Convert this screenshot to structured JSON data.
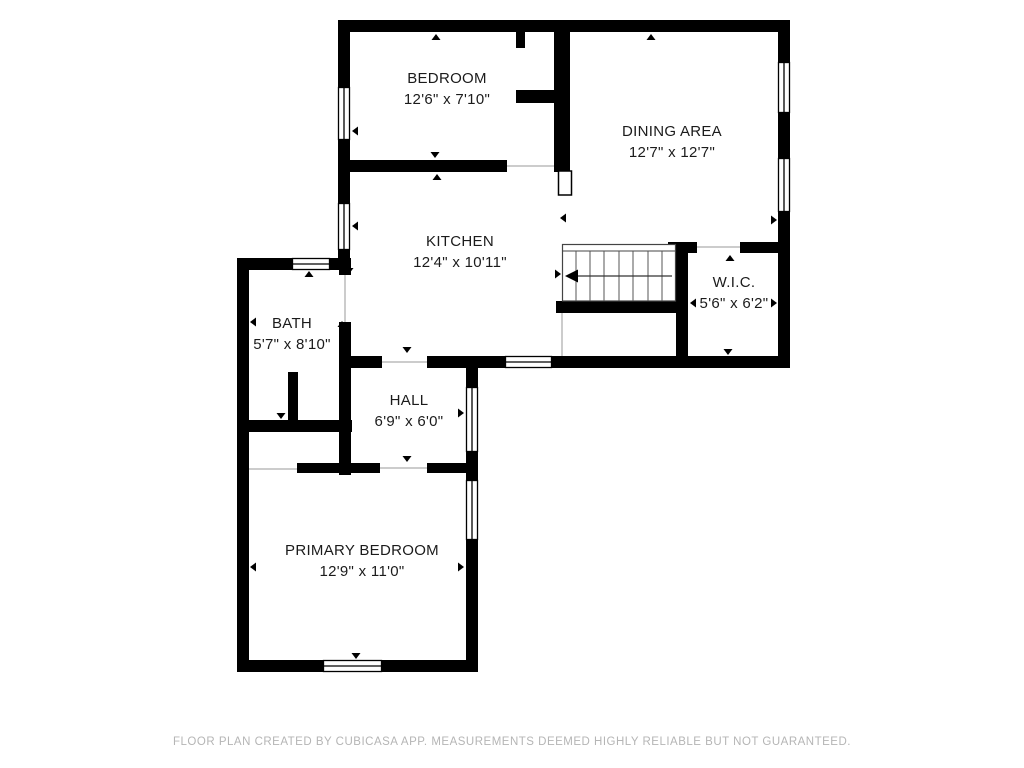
{
  "rooms": [
    {
      "name": "BEDROOM",
      "dims": "12'6\" x 7'10\""
    },
    {
      "name": "DINING AREA",
      "dims": "12'7\" x 12'7\""
    },
    {
      "name": "KITCHEN",
      "dims": "12'4\" x 10'11\""
    },
    {
      "name": "W.I.C.",
      "dims": "5'6\" x 6'2\""
    },
    {
      "name": "BATH",
      "dims": "5'7\" x 8'10\""
    },
    {
      "name": "HALL",
      "dims": "6'9\" x 6'0\""
    },
    {
      "name": "PRIMARY BEDROOM",
      "dims": "12'9\" x 11'0\""
    }
  ],
  "footer": "FLOOR PLAN CREATED BY CUBICASA APP. MEASUREMENTS DEEMED HIGHLY RELIABLE BUT NOT GUARANTEED.",
  "colors": {
    "wall": "#000000",
    "window_fill": "#ffffff",
    "opening_line": "#9a9a9a",
    "tread_line": "#555555",
    "text": "#1b1b1b",
    "footer_text": "#b5b5b5",
    "background": "#ffffff"
  }
}
